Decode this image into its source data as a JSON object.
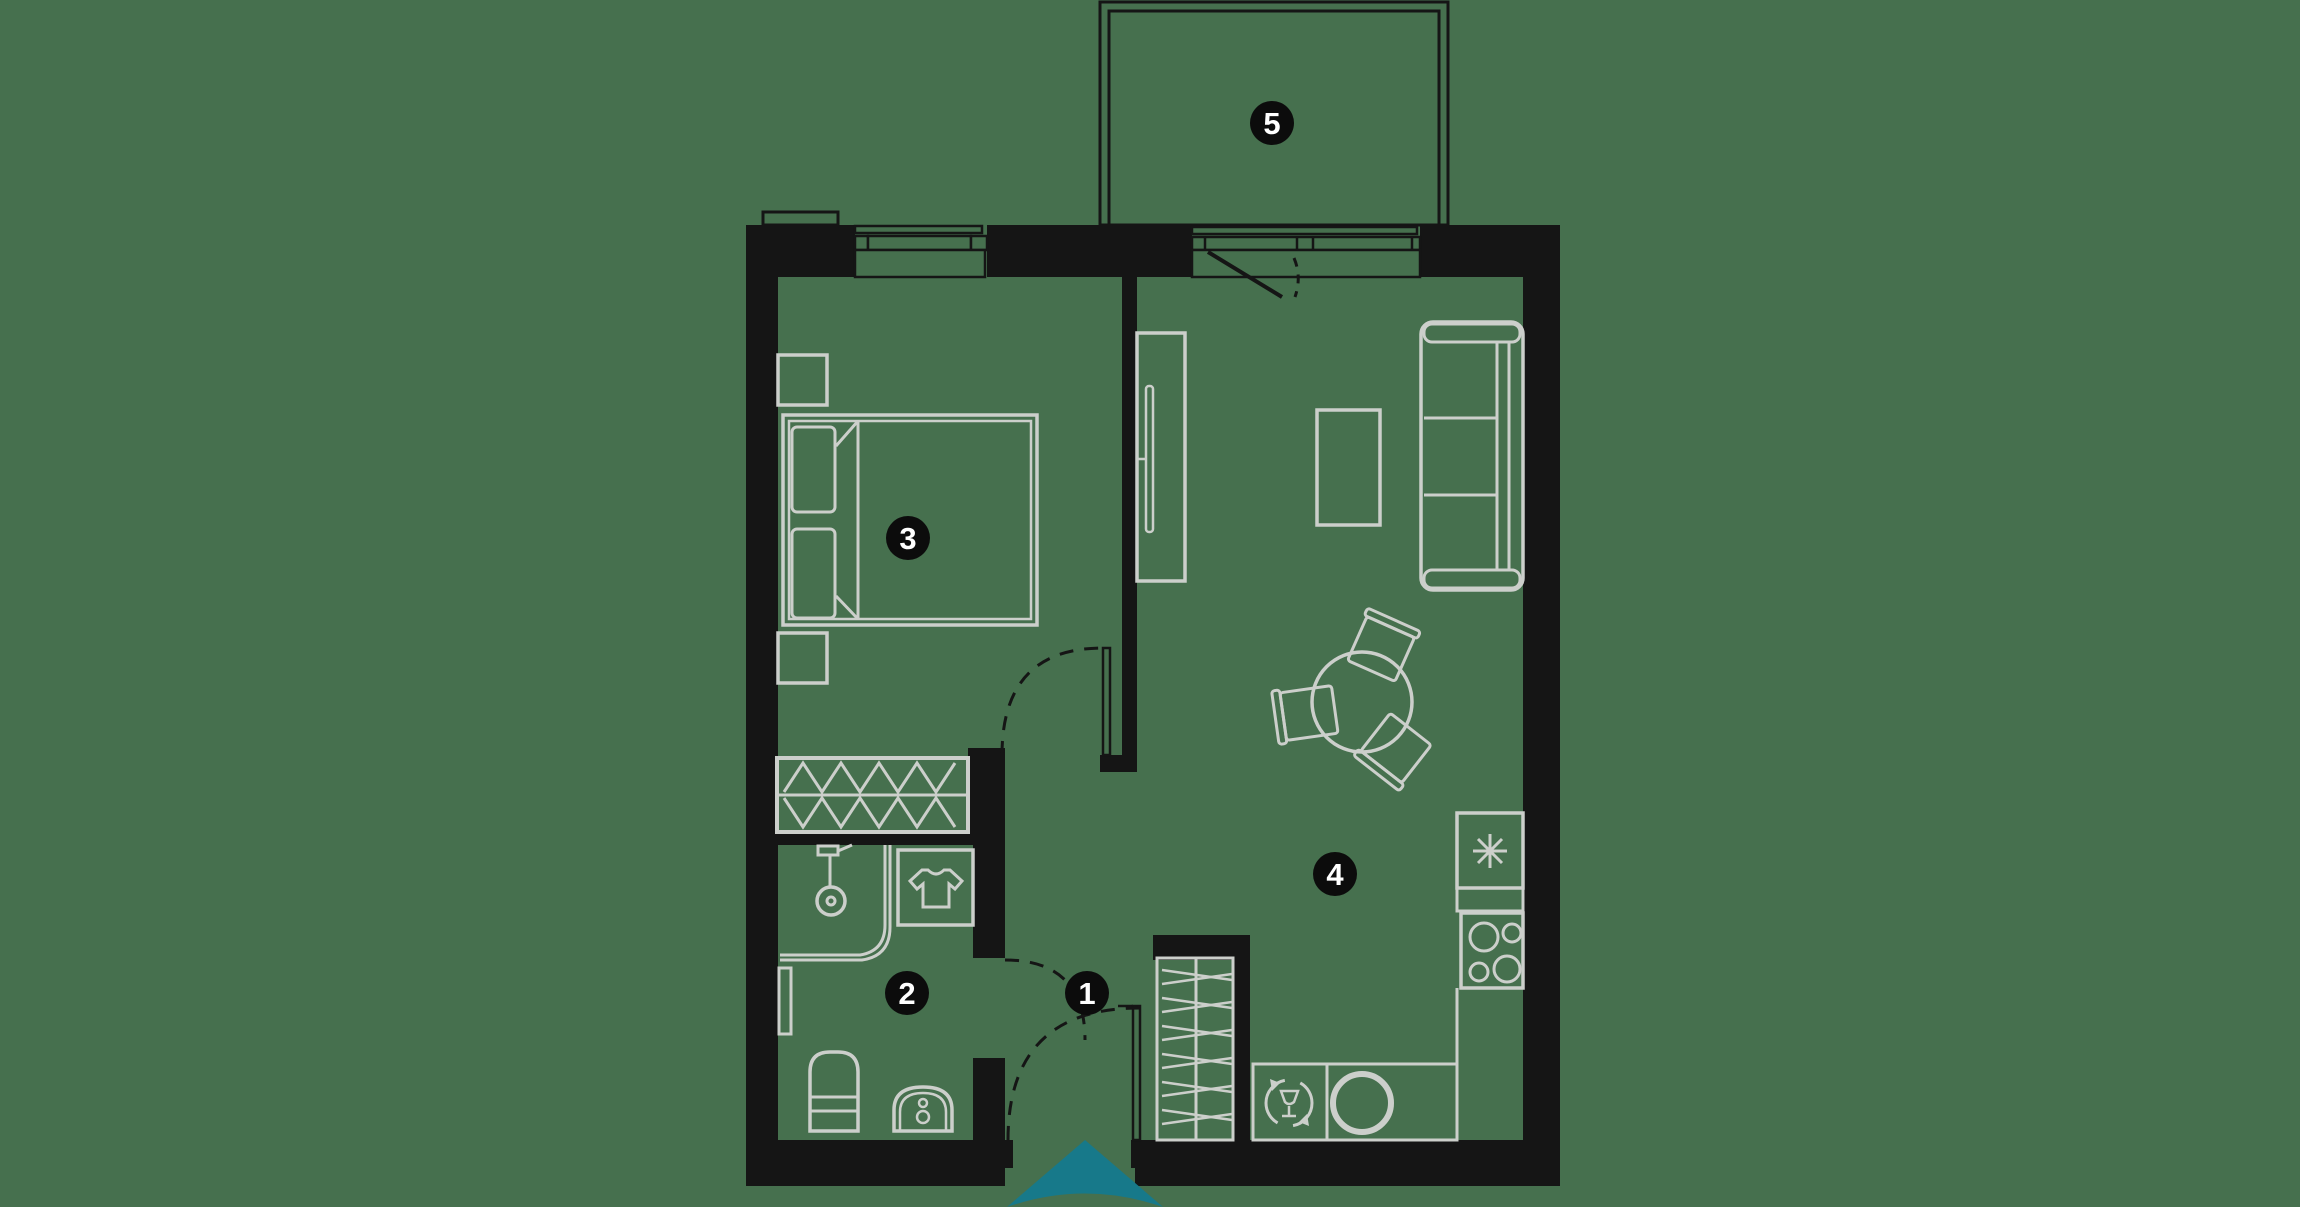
{
  "palette": {
    "background": "#46704e",
    "wall": "#151515",
    "furniture_line": "#cccfcb",
    "window_line": "#151515",
    "label_circle_fill": "#0c0c0c",
    "label_text": "#ffffff",
    "entrance_accent": "#17798a"
  },
  "floor_plan": {
    "type": "apartment-floor-plan",
    "room_labels": [
      {
        "number": "1"
      },
      {
        "number": "2"
      },
      {
        "number": "3"
      },
      {
        "number": "4"
      },
      {
        "number": "5"
      }
    ],
    "icons": [
      "tshirt-icon",
      "shower-icon",
      "toilet-icon",
      "washing-machine-icon",
      "towel-rail-icon",
      "hob-burners-icon",
      "asterisk-icon",
      "dishwasher-icon",
      "sink-basin-icon",
      "wardrobe-hatch-icon",
      "door-swing-icon",
      "entrance-arrow-icon"
    ]
  }
}
